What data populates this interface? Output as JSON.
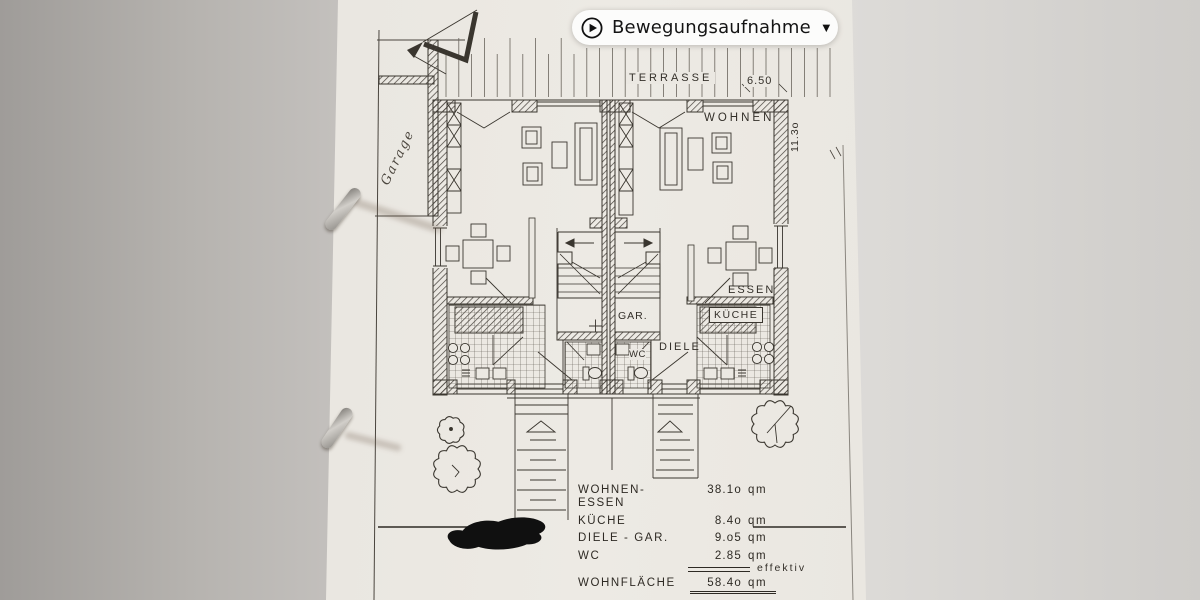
{
  "overlay": {
    "live_badge": {
      "label": "Bewegungsaufnahme",
      "chevron": "▼"
    }
  },
  "plan": {
    "labels": {
      "terrasse": "TERRASSE",
      "terrasse_width": "6.50",
      "wohnen": "WOHNEN",
      "depth": "11.3o",
      "essen": "ESSEN",
      "kueche": "KÜCHE",
      "garderobe": "GAR.",
      "diele": "DIELE",
      "wc": "WC",
      "garage_handwritten": "Garage"
    },
    "area_table": {
      "rows": [
        {
          "label": "WOHNEN- ESSEN",
          "value": "38.1o",
          "unit": "qm"
        },
        {
          "label": "KÜCHE",
          "value": "8.4o",
          "unit": "qm"
        },
        {
          "label": "DIELE - GAR.",
          "value": "9.o5",
          "unit": "qm"
        },
        {
          "label": "WC",
          "value": "2.85",
          "unit": "qm"
        }
      ],
      "total": {
        "label": "WOHNFLÄCHE",
        "value": "58.4o",
        "unit": "qm",
        "note": "effektiv"
      }
    }
  },
  "colors": {
    "badge_bg": "#fcfcfb",
    "ink": "#3a362f",
    "paper": "#ebe8e2"
  }
}
